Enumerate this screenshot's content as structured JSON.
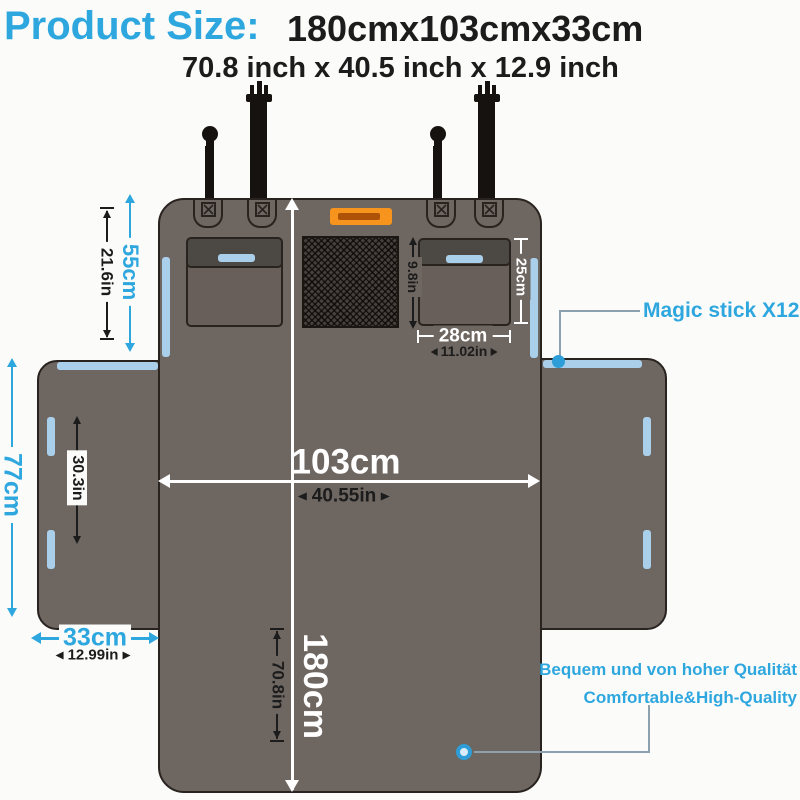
{
  "header": {
    "title": "Product Size:",
    "size_metric": "180cmx103cmx33cm",
    "size_imperial": "70.8 inch x 40.5 inch x 12.9 inch"
  },
  "dimensions": {
    "headrest_panel_height": {
      "metric": "55cm",
      "imperial": "21.6in"
    },
    "mesh_window_height": {
      "imperial": "9.8in"
    },
    "back_pocket_height": {
      "metric": "25cm"
    },
    "back_pocket_width": {
      "metric": "28cm",
      "imperial": "11.02in"
    },
    "cover_width": {
      "metric": "103cm",
      "imperial": "40.55in"
    },
    "cover_length": {
      "metric": "180cm",
      "imperial": "70.8in"
    },
    "side_flap_height": {
      "metric": "77cm",
      "imperial": "30.3in"
    },
    "side_flap_width": {
      "metric": "33cm",
      "imperial": "12.99in"
    }
  },
  "callouts": {
    "magic_stick": "Magic stick X12",
    "quality_de": "Bequem und von hoher Qualität",
    "quality_en": "Comfortable&High-Quality"
  },
  "colors": {
    "accent": "#2EA7DF",
    "ink": "#1C1C1C",
    "white": "#FFFFFF",
    "cover": "#6E6661",
    "pocket": "#695F5A",
    "flap": "#4C4844",
    "mesh": "#45403B",
    "stripe": "#A9CFEA",
    "orange": "#F7941E",
    "outline": "#28231F",
    "connector": "#8CA0AE",
    "dot": "#2D9ED8",
    "strap": "#15120F",
    "bg": "#FBFBFA"
  }
}
